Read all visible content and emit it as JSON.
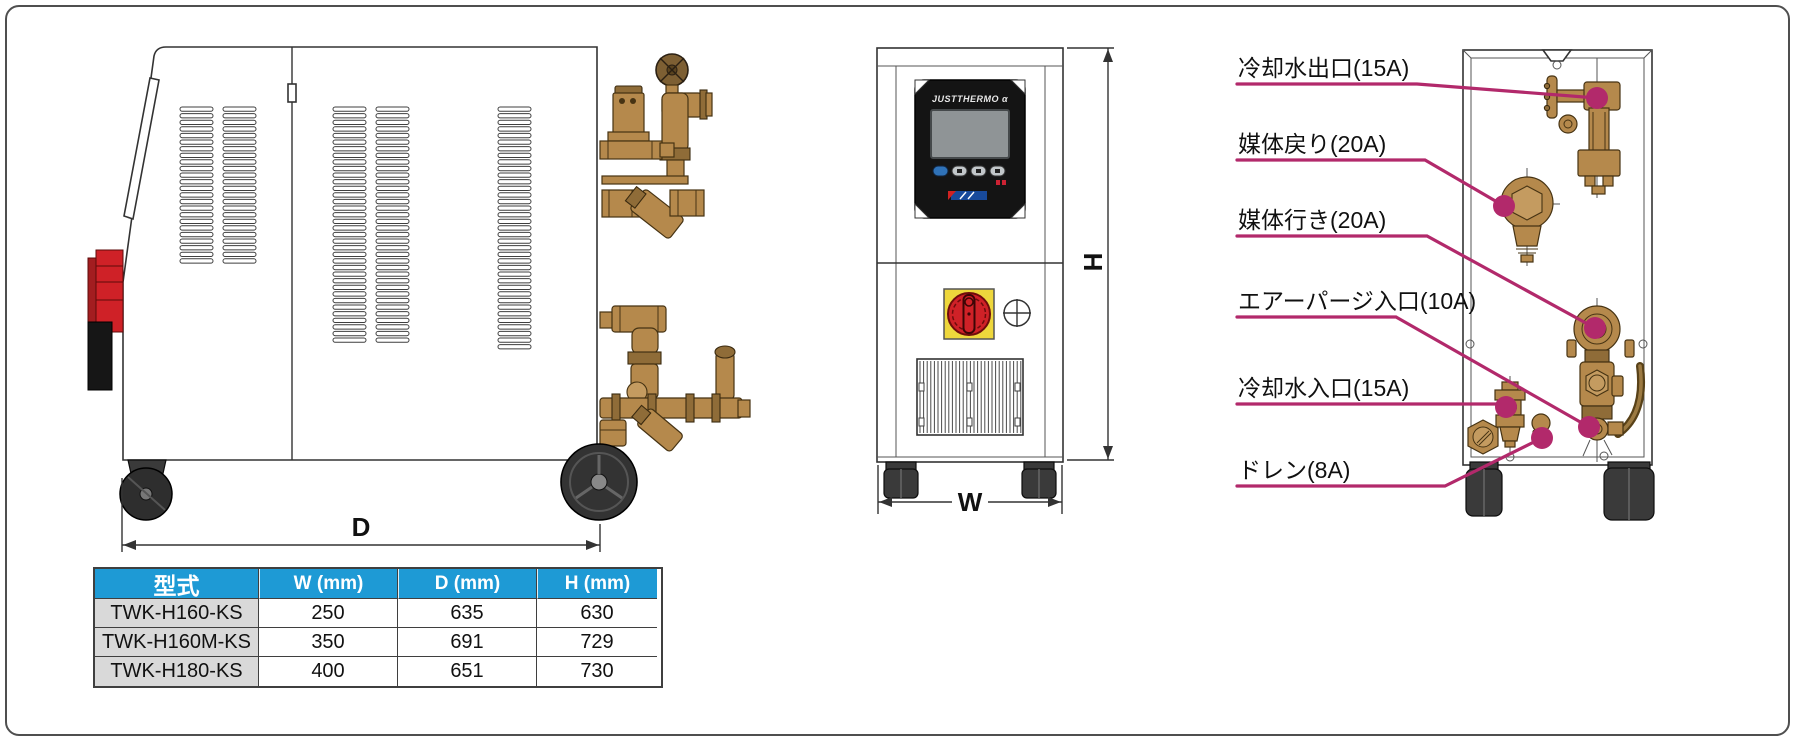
{
  "dims": {
    "depth_label": "D",
    "width_label": "W",
    "height_label": "H"
  },
  "panel": {
    "brand": "JUSTTHERMO α"
  },
  "ports": [
    {
      "label": "冷却水出口(15A)",
      "size": "15A"
    },
    {
      "label": "媒体戻り(20A)",
      "size": "20A"
    },
    {
      "label": "媒体行き(20A)",
      "size": "20A"
    },
    {
      "label": "エアーパージ入口(10A)",
      "size": "10A"
    },
    {
      "label": "冷却水入口(15A)",
      "size": "15A"
    },
    {
      "label": "ドレン(8A)",
      "size": "8A"
    }
  ],
  "table": {
    "headers": {
      "model": "型式",
      "w": "W (mm)",
      "d": "D (mm)",
      "h": "H (mm)"
    },
    "rows": [
      {
        "model": "TWK-H160-KS",
        "w": "250",
        "d": "635",
        "h": "630"
      },
      {
        "model": "TWK-H160M-KS",
        "w": "350",
        "d": "691",
        "h": "729"
      },
      {
        "model": "TWK-H180-KS",
        "w": "400",
        "d": "651",
        "h": "730"
      }
    ]
  },
  "colors": {
    "leader_magenta": "#b2296b",
    "table_header_blue": "#1e9ad5",
    "brass": "#b5894c",
    "switch_red": "#cf2127",
    "switch_yellow": "#eed73c"
  }
}
